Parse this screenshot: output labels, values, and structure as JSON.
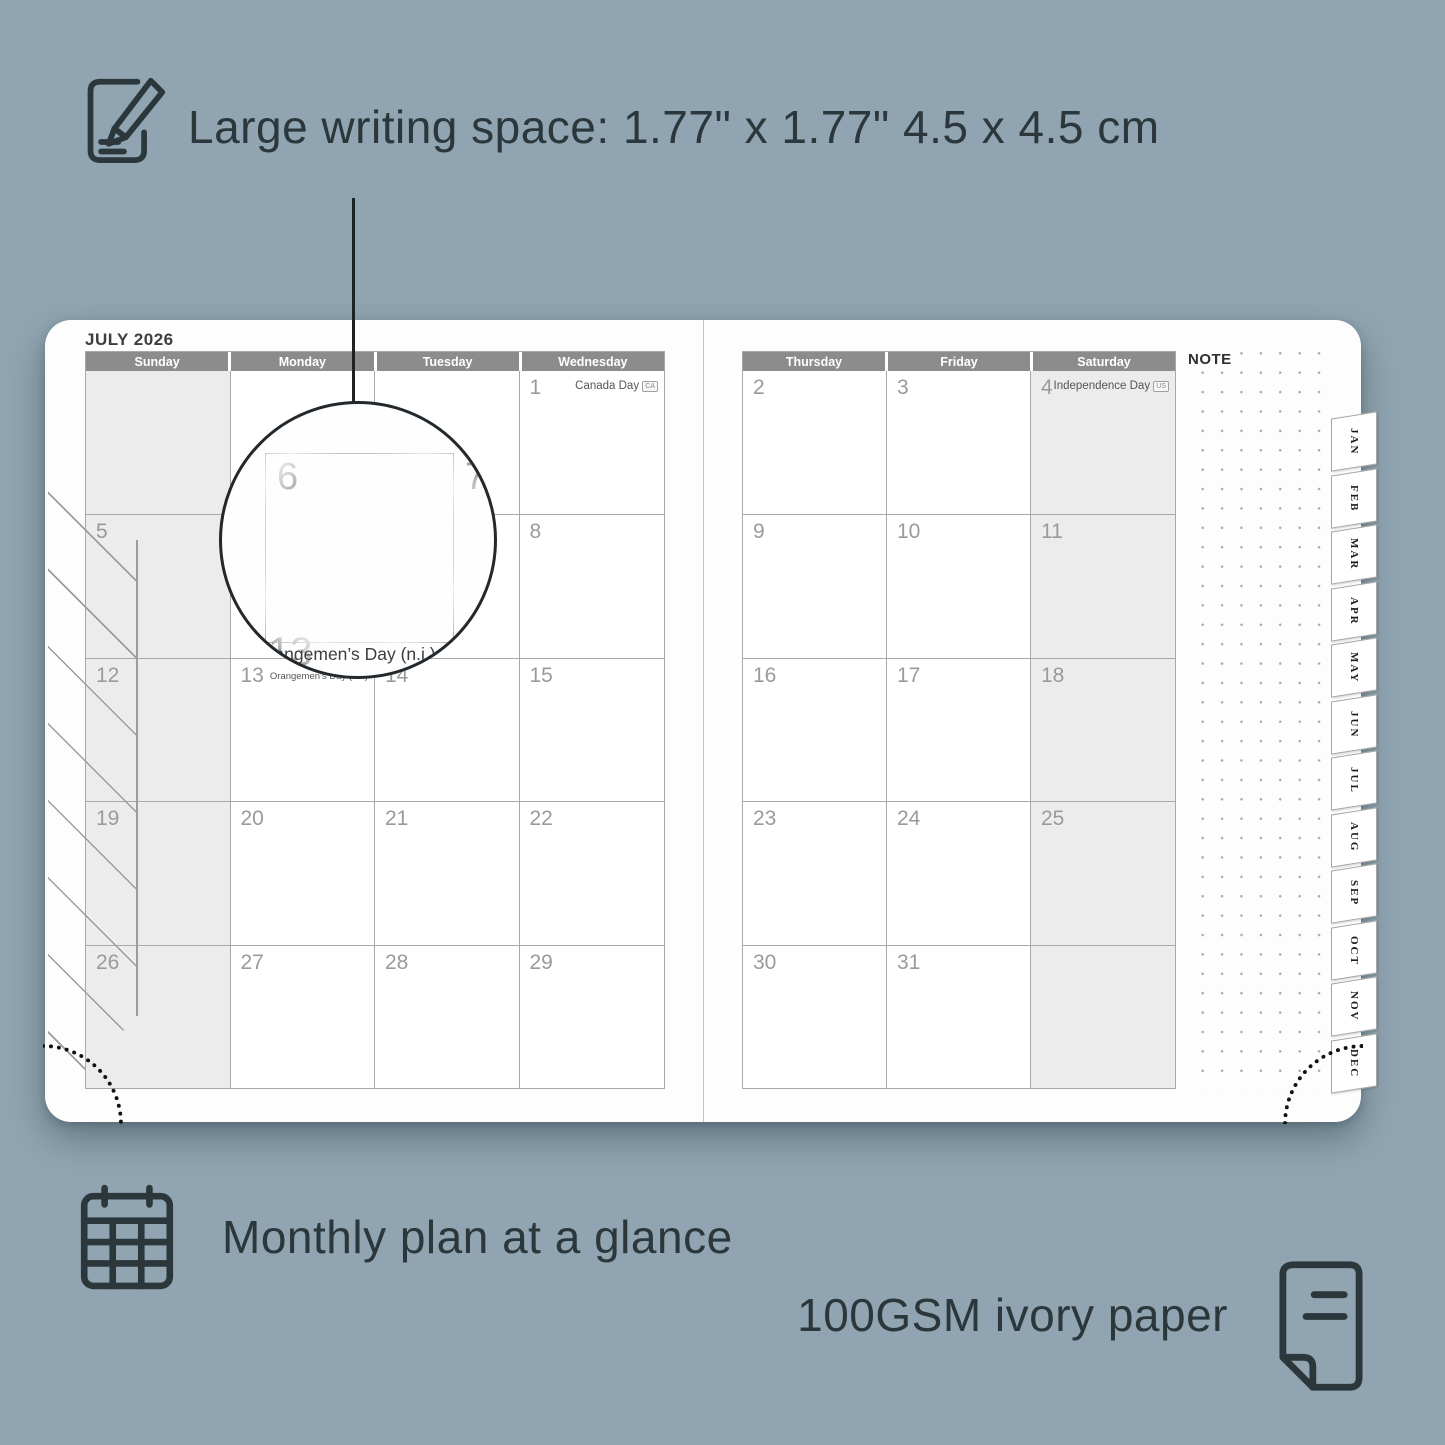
{
  "annotations": {
    "writing_space": "Large writing space: 1.77\" x 1.77\" 4.5 x 4.5 cm",
    "monthly_plan": "Monthly plan at a glance",
    "paper": "100GSM ivory paper"
  },
  "planner": {
    "month_title": "JULY 2026",
    "note_label": "NOTE",
    "left_day_headers": [
      "Sunday",
      "Monday",
      "Tuesday",
      "Wednesday"
    ],
    "right_day_headers": [
      "Thursday",
      "Friday",
      "Saturday"
    ],
    "month_tabs": [
      "JAN",
      "FEB",
      "MAR",
      "APR",
      "MAY",
      "JUN",
      "JUL",
      "AUG",
      "SEP",
      "OCT",
      "NOV",
      "DEC"
    ],
    "left_weeks": [
      [
        {
          "day": ""
        },
        {
          "day": ""
        },
        {
          "day": ""
        },
        {
          "day": "1",
          "holiday": "Canada Day",
          "badge": "CA"
        }
      ],
      [
        {
          "day": "5"
        },
        {
          "day": "6"
        },
        {
          "day": "7"
        },
        {
          "day": "8"
        }
      ],
      [
        {
          "day": "12"
        },
        {
          "day": "13",
          "holiday": "Orangemen’s Day (n.i.)",
          "badge": "UK",
          "inline": true
        },
        {
          "day": "14"
        },
        {
          "day": "15"
        }
      ],
      [
        {
          "day": "19"
        },
        {
          "day": "20"
        },
        {
          "day": "21"
        },
        {
          "day": "22"
        }
      ],
      [
        {
          "day": "26"
        },
        {
          "day": "27"
        },
        {
          "day": "28"
        },
        {
          "day": "29"
        }
      ]
    ],
    "right_weeks": [
      [
        {
          "day": "2"
        },
        {
          "day": "3"
        },
        {
          "day": "4",
          "holiday": "Independence Day",
          "badge": "US"
        }
      ],
      [
        {
          "day": "9"
        },
        {
          "day": "10"
        },
        {
          "day": "11"
        }
      ],
      [
        {
          "day": "16"
        },
        {
          "day": "17"
        },
        {
          "day": "18"
        }
      ],
      [
        {
          "day": "23"
        },
        {
          "day": "24"
        },
        {
          "day": "25"
        }
      ],
      [
        {
          "day": "30"
        },
        {
          "day": "31"
        },
        {
          "day": ""
        }
      ]
    ],
    "magnifier": {
      "day": "6",
      "next_day": "7",
      "below_day": "13",
      "holiday": "Orangemen’s Day (n.i.)",
      "badge": "UK"
    }
  },
  "colors": {
    "background": "#90a5b1",
    "ink": "#2c373c",
    "header_bar": "#8c8c8c",
    "weekend_fill": "#ececec",
    "grid_line": "#a8a8a8",
    "day_number": "#9a9a9a"
  }
}
